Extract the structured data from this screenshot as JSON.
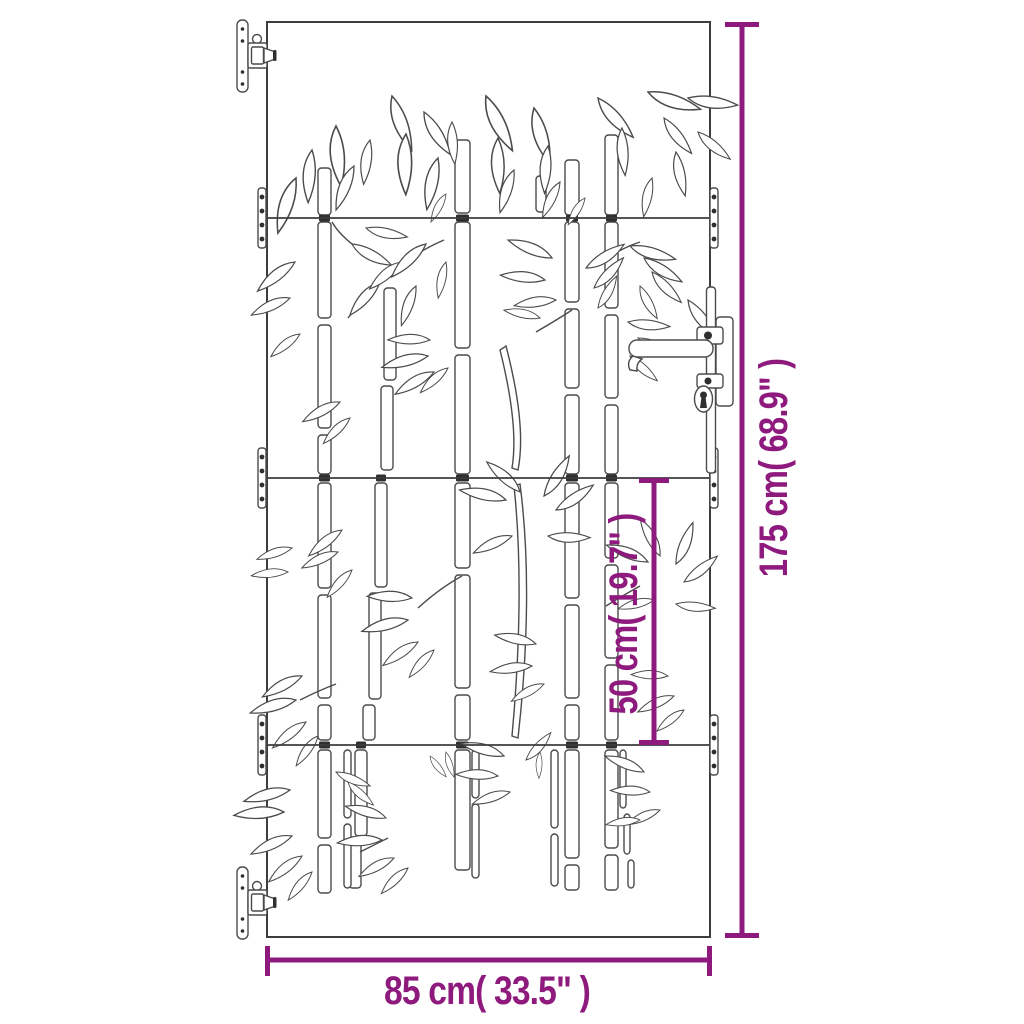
{
  "colors": {
    "accent": "#8e1a7e",
    "line_art": "#4b4b4b",
    "background": "#ffffff"
  },
  "dimensions": {
    "height": {
      "label": "175 cm( 68.9\" )",
      "orientation": "vertical"
    },
    "inner_height": {
      "label": "50 cm( 19.7\" )",
      "orientation": "vertical"
    },
    "width": {
      "label": "85 cm( 33.5\" )",
      "orientation": "horizontal"
    }
  },
  "illustration": {
    "subject": "garden gate with laser-cut bamboo design",
    "panel_count": 4,
    "parts": [
      "wall-hinge-top",
      "wall-hinge-bottom",
      "panel-joint-plates",
      "lever-handle-with-keyhole",
      "bamboo-stalks",
      "bamboo-leaves"
    ]
  }
}
